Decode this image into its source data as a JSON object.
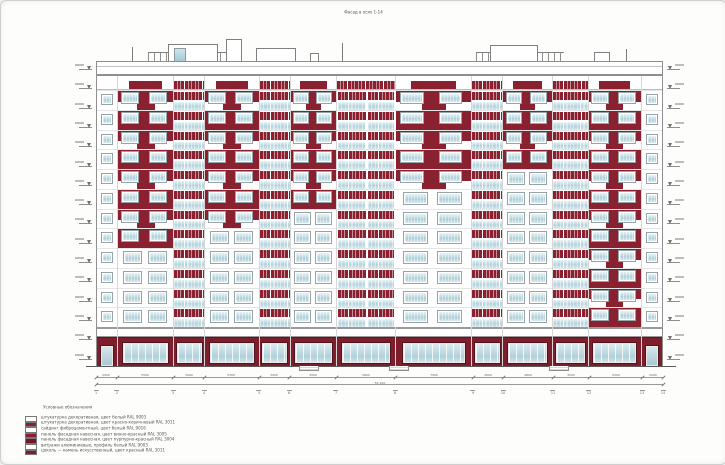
{
  "page": {
    "title": "Фасад в осях 1-14"
  },
  "colors": {
    "maroon": "#8a2130",
    "maroon_dark": "#6e1a26",
    "ground_maroon": "#7e1e2c",
    "glass_blue": "#b3d2da",
    "line_gray": "#8f8f8f"
  },
  "building": {
    "upper_floors": 12,
    "bays": [
      {
        "type": "stair",
        "w": 20
      },
      {
        "type": "red",
        "w": 55,
        "redFloors": 8
      },
      {
        "type": "balcony",
        "w": 30
      },
      {
        "type": "red",
        "w": 53,
        "redFloors": 7
      },
      {
        "type": "balcony",
        "w": 30
      },
      {
        "type": "red",
        "w": 45,
        "redFloors": 6
      },
      {
        "type": "balcony-wide",
        "w": 58
      },
      {
        "type": "red",
        "w": 75,
        "redFloors": 5
      },
      {
        "type": "balcony",
        "w": 30
      },
      {
        "type": "red",
        "w": 48,
        "redFloors": 4
      },
      {
        "type": "balcony",
        "w": 35
      },
      {
        "type": "red",
        "w": 52,
        "redFloors": 12
      },
      {
        "type": "stair",
        "w": 20
      }
    ],
    "roof_items": [
      {
        "type": "railing",
        "x": 52,
        "w": 90,
        "h": 9
      },
      {
        "type": "box",
        "x": 72,
        "w": 48,
        "h": 17
      },
      {
        "type": "glass",
        "x": 78,
        "w": 10,
        "h": 13
      },
      {
        "type": "box",
        "x": 130,
        "w": 14,
        "h": 22
      },
      {
        "type": "box",
        "x": 160,
        "w": 38,
        "h": 13
      },
      {
        "type": "vent",
        "x": 214,
        "w": 7,
        "h": 8
      },
      {
        "type": "railing",
        "x": 380,
        "w": 88,
        "h": 9
      },
      {
        "type": "box",
        "x": 394,
        "w": 46,
        "h": 16
      },
      {
        "type": "box",
        "x": 498,
        "w": 14,
        "h": 9
      },
      {
        "type": "antenna",
        "x": 36,
        "w": 1,
        "h": 14
      },
      {
        "type": "antenna",
        "x": 246,
        "w": 1,
        "h": 18
      },
      {
        "type": "antenna",
        "x": 530,
        "w": 1,
        "h": 12
      }
    ],
    "entrance_steps_x": [
      298,
      388,
      548
    ]
  },
  "markers": {
    "left_count": 16,
    "right_count": 16
  },
  "dimensions": {
    "segments": [
      "2000",
      "5500",
      "3000",
      "5300",
      "3000",
      "4500",
      "5800",
      "7500",
      "3000",
      "4800",
      "3500",
      "5200",
      "2000"
    ],
    "total": "55 100",
    "axes": [
      "1",
      "2",
      "3",
      "4",
      "5",
      "6",
      "7",
      "8",
      "9",
      "10",
      "11",
      "12",
      "13",
      "14"
    ]
  },
  "legend": {
    "title": "Условные обозначения",
    "items": [
      {
        "swatch": "#ffffff",
        "label": "штукатурка декоративная, цвет белый RAL 9003"
      },
      {
        "swatch": "#8a2130",
        "label": "штукатурка декоративная, цвет красно-коричневый RAL 3011"
      },
      {
        "swatch": "#ffffff",
        "label": "сайдинг фиброцементный, цвет белый RAL 9016"
      },
      {
        "swatch": "#8a2130",
        "label": "панель фасадная навесная, цвет винно-красный RAL 3005"
      },
      {
        "swatch": "#6e1a26",
        "label": "панель фасадная навесная, цвет пурпурно-красный RAL 3004"
      },
      {
        "swatch": "#ffffff",
        "label": "витражи алюминиевые, профиль белый RAL 9003"
      },
      {
        "swatch": "#7e1e2c",
        "label": "цоколь — камень искусственный, цвет красный RAL 3011"
      }
    ]
  }
}
